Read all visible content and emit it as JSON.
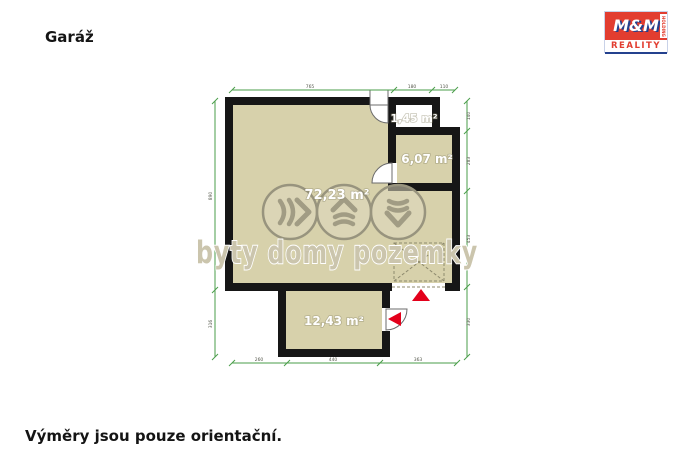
{
  "title": "Garáž",
  "footer_note": "Výměry jsou pouze orientační.",
  "logo": {
    "mm": "M&M",
    "reality": "REALITY",
    "holding": "HOLDING"
  },
  "watermark": {
    "text": "byty domy pozemky"
  },
  "rooms": {
    "main": {
      "area_label": "72,23 m²"
    },
    "storage": {
      "area_label": "6,07 m²"
    },
    "entry": {
      "area_label": "1,45 m²"
    },
    "annex": {
      "area_label": "12,43 m²"
    }
  },
  "dimensions": {
    "top_left": "765",
    "top_mid": "180",
    "top_right": "110",
    "left_upper": "890",
    "left_lower": "316",
    "right_1": "140",
    "right_2": "283",
    "right_3": "453",
    "right_4": "330",
    "bottom_left": "260",
    "bottom_mid": "440",
    "bottom_right": "363"
  },
  "colors": {
    "floor": "#d7d1ab",
    "wall": "#161616",
    "dimension_line": "#4a9e4a",
    "marker_red": "#e3001b",
    "watermark_gray": "#cbc5ad",
    "logo_red": "#e23d30",
    "logo_blue": "#24418e"
  }
}
